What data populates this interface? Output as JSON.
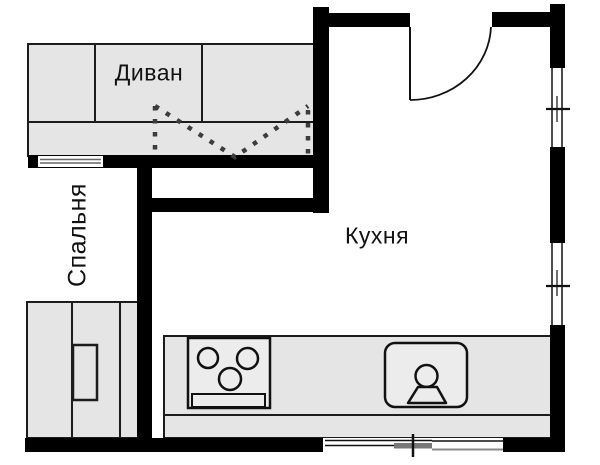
{
  "floor_plan": {
    "labels": {
      "sofa": "Диван",
      "bedroom": "Спальня",
      "kitchen": "Кухня"
    },
    "colors": {
      "wall": "#000000",
      "furniture_fill": "#e5e5e5",
      "outline": "#1c1c1c",
      "background": "#ffffff",
      "partition_dots": "#3c3c3c",
      "window_gray": "#787878"
    }
  }
}
